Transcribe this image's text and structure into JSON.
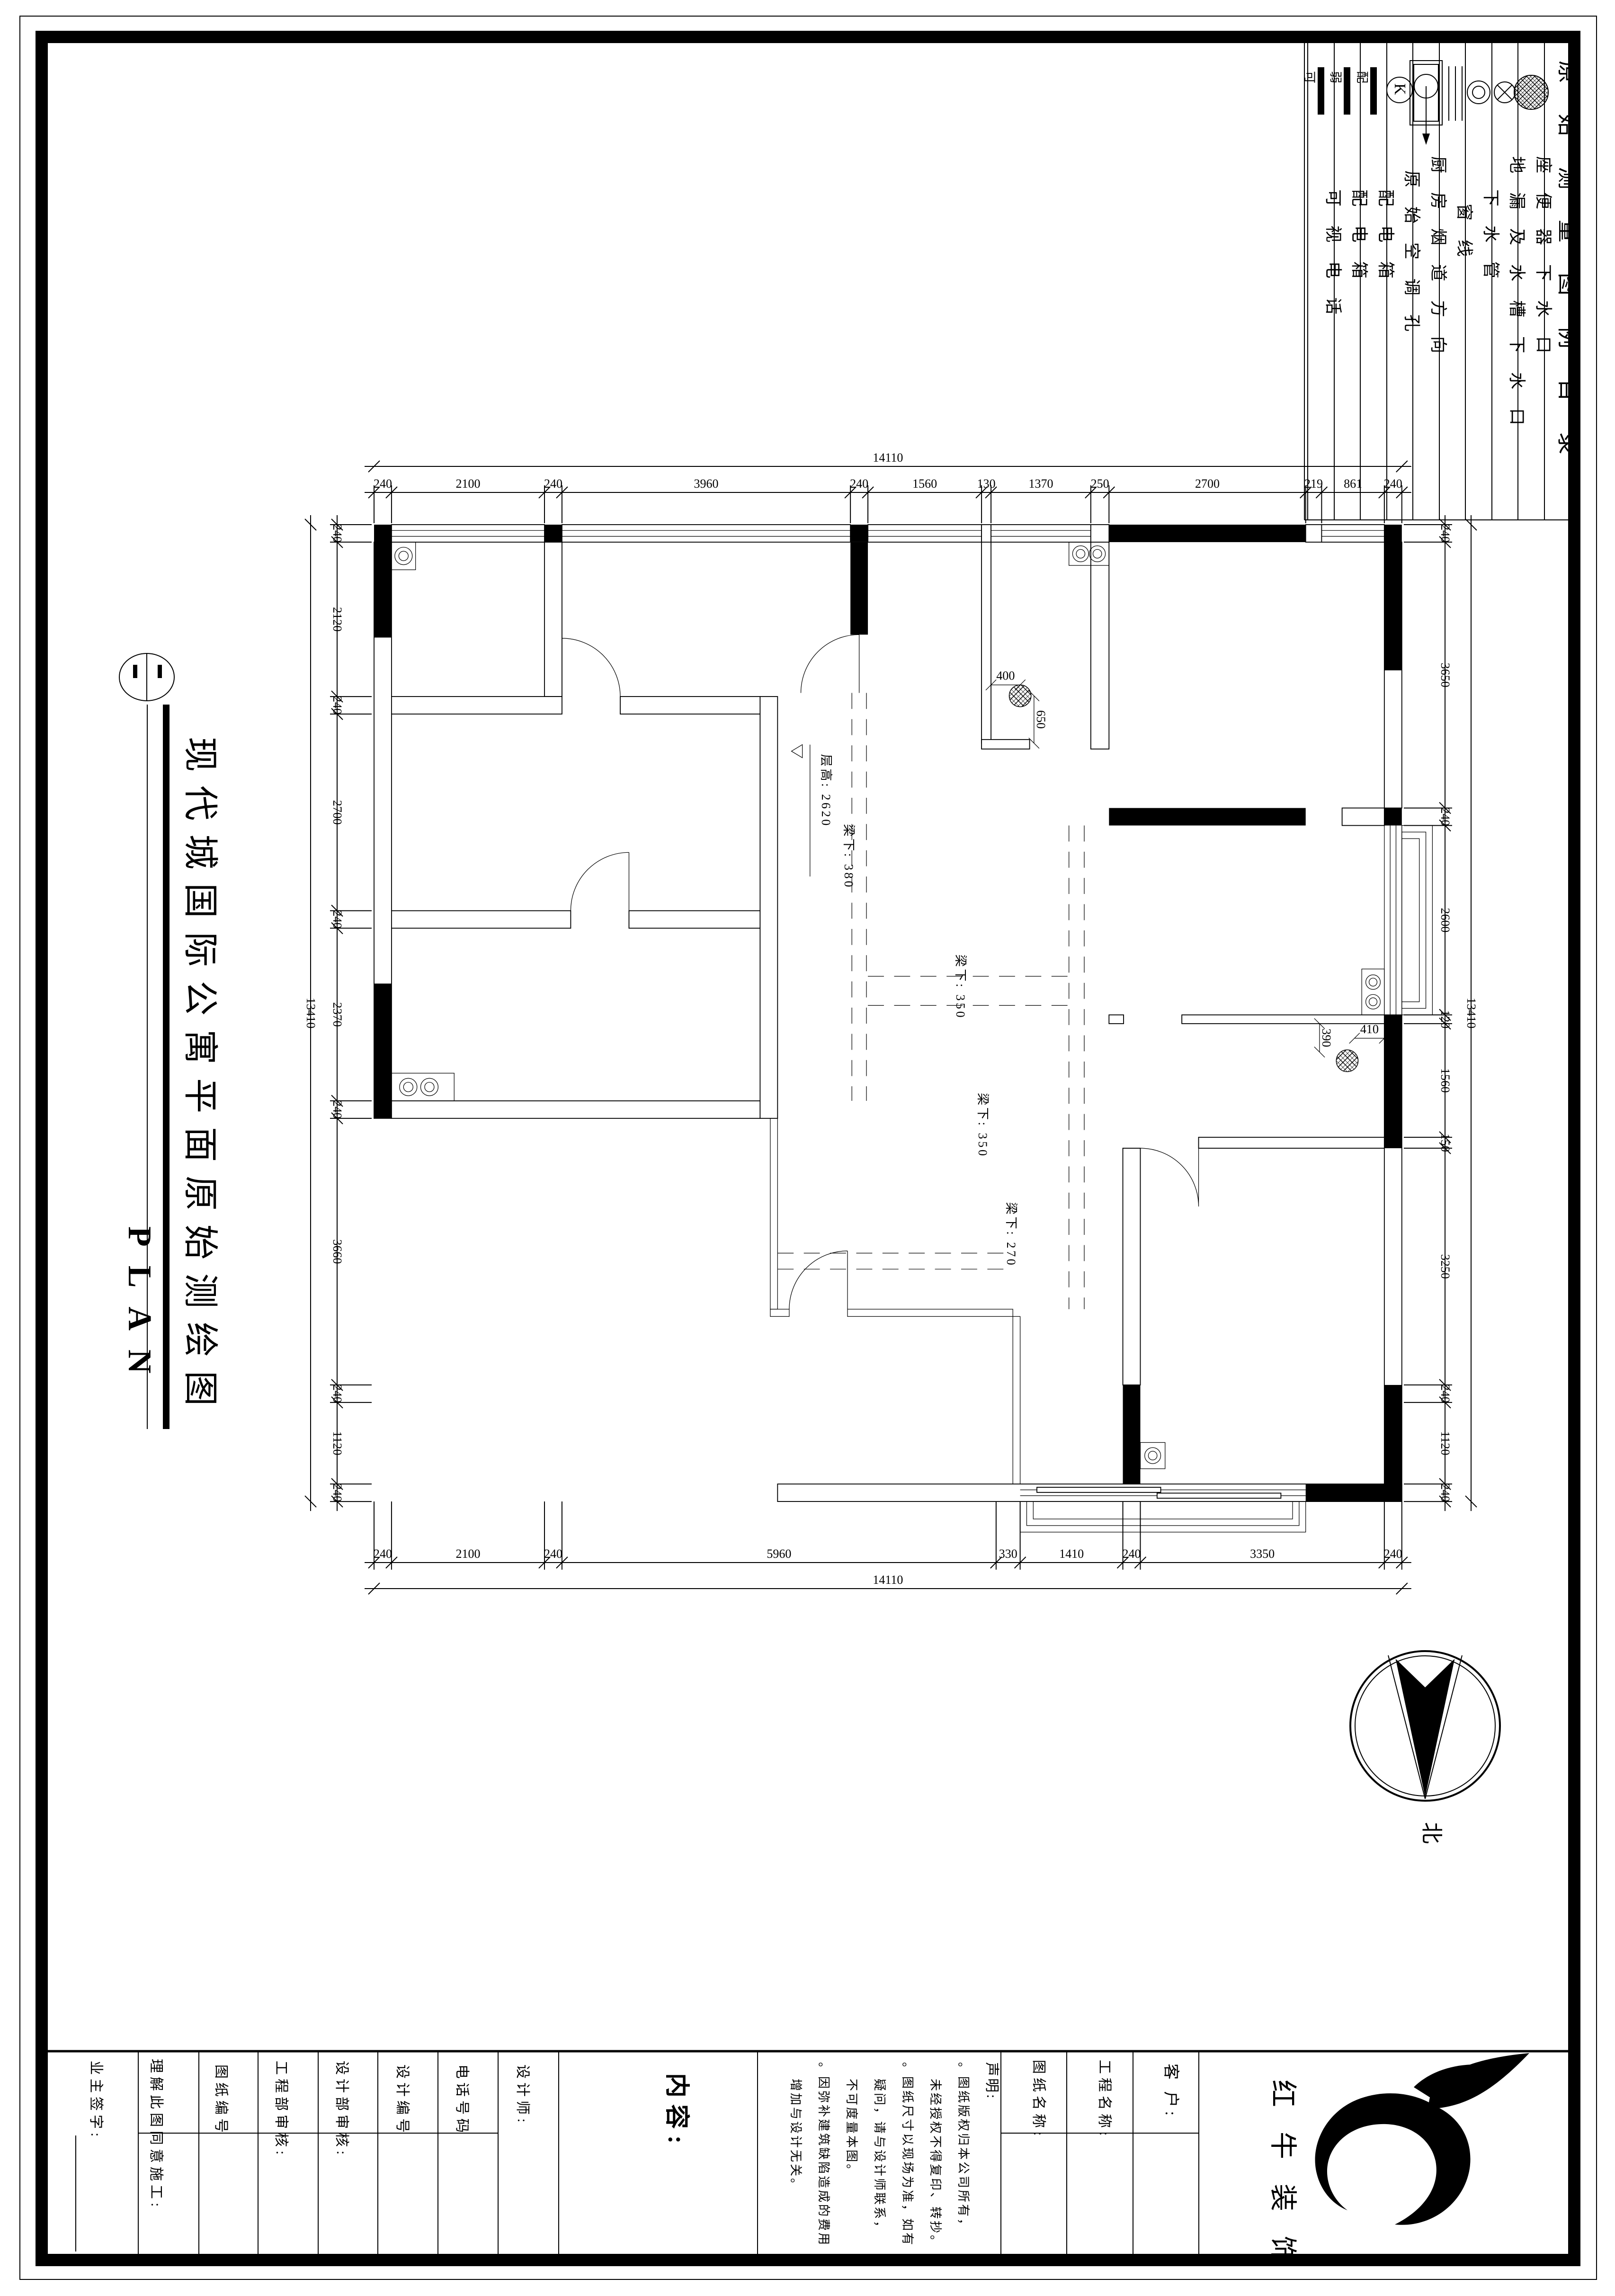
{
  "sheet": {
    "legend": {
      "title": "原始测量图例目录",
      "items": [
        {
          "label": "座便器下水口"
        },
        {
          "label": "地漏及水槽下水口"
        },
        {
          "label": "下水管"
        },
        {
          "label": "窗线"
        },
        {
          "label": "厨房烟道方向"
        },
        {
          "label": "原始空调孔"
        },
        {
          "label": "配电箱"
        },
        {
          "label": "配电箱"
        },
        {
          "label": "可视电话"
        }
      ],
      "icon_chars": {
        "k": "K",
        "pei": "配",
        "ruo": "弱",
        "ke": "可"
      }
    },
    "title": {
      "main": "现代城国际公寓平面原始测绘图",
      "en": "PLAN"
    },
    "compass": {
      "label": "北"
    },
    "annotations": {
      "ceiling": "层高: 2620",
      "beam380": "梁下: 380",
      "beam350a": "梁下: 350",
      "beam350b": "梁下: 350",
      "beam270": "梁下: 270",
      "d400": "400",
      "d650": "650",
      "d410": "410",
      "d390": "390"
    },
    "dims": {
      "top": {
        "total": [
          14110
        ],
        "segments": [
          240,
          2100,
          240,
          3960,
          240,
          1560,
          130,
          1370,
          250,
          2700,
          219,
          861,
          240
        ]
      },
      "bottom": {
        "total": [
          14110
        ],
        "segments": [
          240,
          2100,
          240,
          5960,
          330,
          1410,
          240,
          3350,
          240
        ]
      },
      "left": {
        "total": [
          13410
        ],
        "segments": [
          240,
          2120,
          240,
          2700,
          240,
          2370,
          240,
          3660,
          240,
          1120,
          240
        ]
      },
      "right": {
        "total": [
          13410
        ],
        "segments": [
          240,
          3650,
          240,
          2600,
          120,
          1560,
          150,
          3250,
          240,
          1120,
          240
        ]
      }
    },
    "titleblock": {
      "customer": "客 户:",
      "project": "工程名称:",
      "drawing": "图纸名称:",
      "declaration": [
        "声明:",
        "。图纸版权归本公司所有，",
        "未经授权不得复印、转抄。",
        "。图纸尺寸以现场为准，如有",
        "疑问，请与设计师联系，",
        "不可度量本图。",
        "。因弥补建筑缺陷造成的费用",
        "增加与设计无关。"
      ],
      "content": "内容:",
      "designer": "设计师:",
      "phone": "电话号码",
      "design_no": "设计编号",
      "design_review": "设计部审核:",
      "eng_review": "工程部审核:",
      "drawing_no": "图纸编号",
      "agree": "理解此图同意施工:",
      "owner_sign": "业主签字:",
      "company": "红牛装饰"
    }
  }
}
